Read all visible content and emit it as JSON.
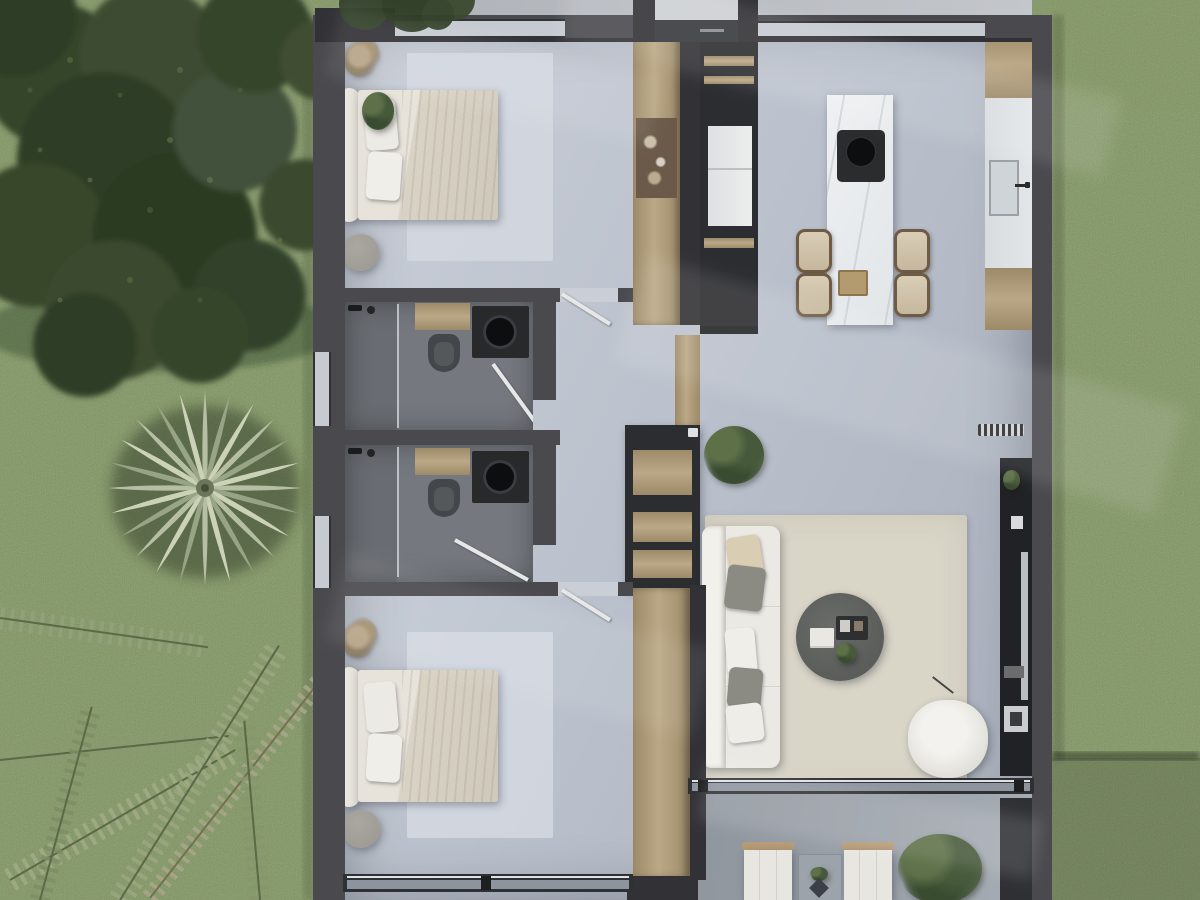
{
  "scene": {
    "type": "photoreal-top-down-floor-plan-render",
    "title": "apartment floor plan aerial 3d render",
    "visible_text": [],
    "environment": {
      "left": [
        "lawn",
        "large-leafy-tree",
        "fan-palm-tree",
        "palm-fronds"
      ],
      "right": [
        "lawn",
        "mowing-seam-shadow"
      ],
      "top": [
        "concrete-entry-walkway",
        "entry-vestibule"
      ]
    },
    "rooms": [
      {
        "name": "bedroom-1",
        "position": "top-left",
        "furniture": [
          "double-bed",
          "headboard",
          "two-pillows",
          "textured-duvet",
          "area-rug",
          "dried-corner-plant",
          "green-plant",
          "floor-pouf",
          "wood-wardrobe"
        ]
      },
      {
        "name": "kitchen",
        "position": "top-right",
        "furniture": [
          "marble-island",
          "induction-cooktop",
          "wood-tray",
          "four-rattan-stools",
          "tall-dark-pantry",
          "refrigerator",
          "counter-with-sink",
          "faucet",
          "window-strip"
        ]
      },
      {
        "name": "bathroom-1",
        "position": "middle-left",
        "furniture": [
          "walk-in-shower",
          "glass-partition",
          "wood-vanity",
          "dark-basin-unit",
          "toilet",
          "open-door",
          "frosted-window"
        ]
      },
      {
        "name": "bathroom-2",
        "position": "middle-left-lower",
        "furniture": [
          "walk-in-shower",
          "glass-partition",
          "wood-vanity",
          "dark-basin-unit",
          "toilet",
          "open-door",
          "frosted-window"
        ]
      },
      {
        "name": "hallway",
        "position": "center",
        "furniture": [
          "console-shelf-unit",
          "potted-plant",
          "wood-floor-transition"
        ]
      },
      {
        "name": "living-room",
        "position": "right",
        "furniture": [
          "white-sofa",
          "five-cushions",
          "round-coffee-table",
          "book-stack",
          "decor-tray",
          "armchair",
          "floor-lamp",
          "cream-area-rug",
          "media-console",
          "tv-panel",
          "vent-grille"
        ]
      },
      {
        "name": "bedroom-2",
        "position": "bottom-left",
        "furniture": [
          "double-bed",
          "headboard",
          "two-pillows",
          "area-rug",
          "dried-corner-plant",
          "floor-pouf",
          "wood-wardrobe",
          "sliding-glass-door"
        ]
      },
      {
        "name": "terrace",
        "position": "bottom-right",
        "furniture": [
          "two-sun-loungers",
          "side-table",
          "decor-pyramid",
          "potted-plant",
          "garden-bush",
          "sliding-glass-door",
          "dark-storage-block"
        ]
      },
      {
        "name": "entry",
        "position": "top-center",
        "furniture": [
          "entry-door",
          "doormat"
        ]
      }
    ]
  },
  "palette": {
    "grass": "#3f4a2b",
    "canopy": "#34432a",
    "concrete": "#b7bbc0",
    "wall": "#4a4a4e",
    "wall_dark": "#323236",
    "cabinet": "#2c2d30",
    "floor_a": "#c9ced7",
    "floor_b": "#a8afbb",
    "bath_floor": "#75797f",
    "wood": "#bba886",
    "wood_dark": "#9c8a68",
    "wood_light": "#c9b795",
    "island": "#eef0f1",
    "steel": "#e3e6e9",
    "window": "#c6cbd1",
    "glass": "#8d949e",
    "white_soft": "#ebe9e3",
    "pillow_gray": "#8b8a83",
    "pillow_beige": "#d9cdb4",
    "rug_living": "#d9d5c7",
    "rug_bed": "#d3d8e0",
    "table_round": "#5b5d5b",
    "patio": "#9aa0a8",
    "black": "#0c0e10",
    "pouf": "#9b9892"
  }
}
